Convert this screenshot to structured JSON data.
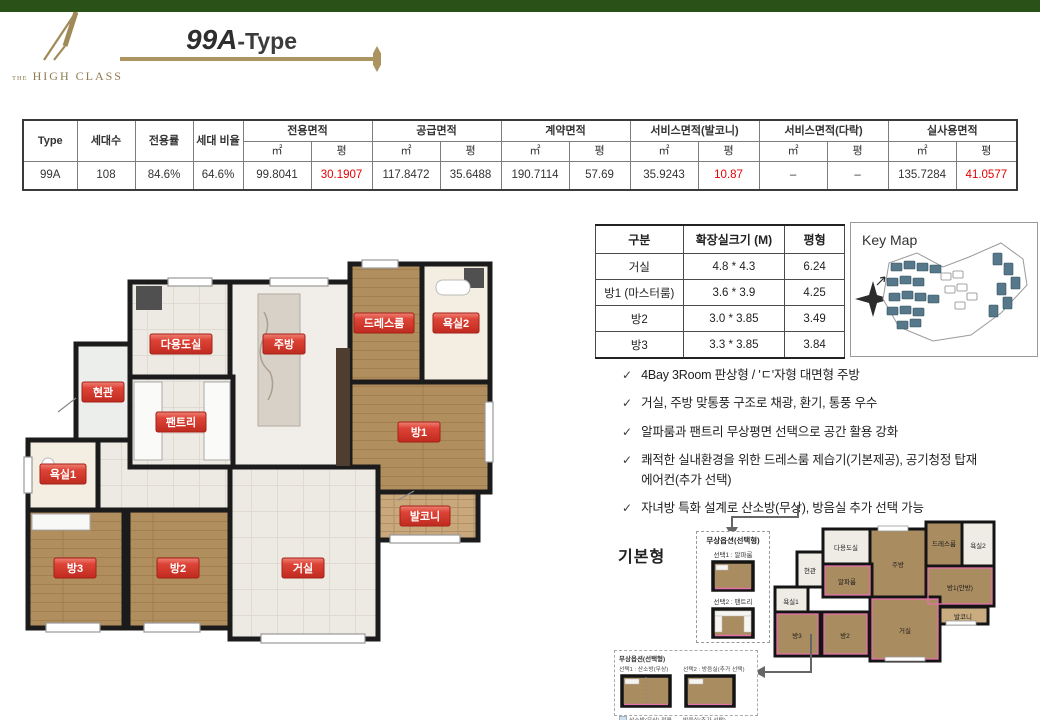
{
  "header": {
    "brand_the": "THE",
    "brand_name": "HIGH CLASS",
    "title_main": "99A",
    "title_suffix": "-Type"
  },
  "spec_table": {
    "col_type": "Type",
    "col_households": "세대수",
    "col_exclusive_rate": "전용률",
    "col_household_ratio": "세대 비율",
    "groups": [
      "전용면적",
      "공급면적",
      "계약면적",
      "서비스면적(발코니)",
      "서비스면적(다락)",
      "실사용면적"
    ],
    "unit_m2": "㎡",
    "unit_py": "평",
    "row": {
      "type": "99A",
      "households": "108",
      "exclusive_rate": "84.6%",
      "household_ratio": "64.6%",
      "values": [
        "99.8041",
        "30.1907",
        "117.8472",
        "35.6488",
        "190.7114",
        "57.69",
        "35.9243",
        "10.87",
        "–",
        "–",
        "135.7284",
        "41.0577"
      ]
    }
  },
  "room_table": {
    "headers": [
      "구분",
      "확장실크기 (M)",
      "평형"
    ],
    "rows": [
      [
        "거실",
        "4.8 * 4.3",
        "6.24"
      ],
      [
        "방1 (마스터룸)",
        "3.6 * 3.9",
        "4.25"
      ],
      [
        "방2",
        "3.0 * 3.85",
        "3.49"
      ],
      [
        "방3",
        "3.3 * 3.85",
        "3.84"
      ]
    ]
  },
  "key_map": {
    "title": "Key Map"
  },
  "features": {
    "check": "✓",
    "items": [
      "4Bay 3Room 판상형 / 'ㄷ'자형 대면형 주방",
      "거실, 주방 맞통풍 구조로 채광, 환기, 통풍 우수",
      "알파룸과 팬트리 무상평면 선택으로 공간 활용 강화",
      "쾌적한 실내환경을 위한 드레스룸 제습기(기본제공), 공기청정 탑재\n에어컨(추가 선택)",
      "자녀방 특화 설계로 산소방(무상), 방음실 추가 선택 가능"
    ]
  },
  "floor_plan": {
    "rooms": {
      "utility": "다용도실",
      "kitchen": "주방",
      "dress": "드레스룸",
      "bath2": "욕실2",
      "entrance": "현관",
      "pantry": "팬트리",
      "bath1": "욕실1",
      "room1": "방1",
      "balcony": "발코니",
      "room3": "방3",
      "room2": "방2",
      "living": "거실"
    }
  },
  "basic_plan": {
    "label": "기본형",
    "option_box": {
      "title": "무상옵션(선택형)",
      "option1": "선택1 : 알파룸",
      "option2": "선택2 : 팬트리"
    },
    "mini_rooms": {
      "utility": "다용도실",
      "entrance": "현관",
      "alpha": "알파룸",
      "kitchen": "주방",
      "dress": "드레스룸",
      "bath2": "욕실2",
      "bath1": "욕실1",
      "room1": "방1(안방)",
      "balcony": "발코니",
      "room3": "방3",
      "room2": "방2",
      "living": "거실"
    },
    "bottom_box": {
      "title": "무상옵션(선택형)",
      "option1": "선택1 : 산소방(무상)",
      "option2": "선택2 : 방음실(추가 선택)",
      "caption1": "산소방(무상) 적용",
      "caption2": "방음실(추가 선택)"
    }
  },
  "colors": {
    "accent_green": "#2a5117",
    "gold": "#ab9460",
    "label_red": "#d6362b",
    "red_text": "#e60000",
    "keymap_building": "#56788a",
    "option_pink": "#e571ac"
  }
}
